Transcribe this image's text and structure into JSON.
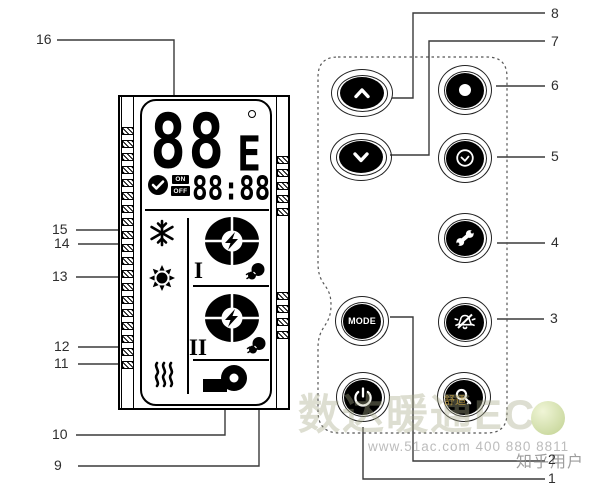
{
  "callouts": {
    "1": "1",
    "2": "2",
    "3": "3",
    "4": "4",
    "5": "5",
    "6": "6",
    "7": "7",
    "8": "8",
    "9": "9",
    "10": "10",
    "11": "11",
    "12": "12",
    "13": "13",
    "14": "14",
    "15": "15",
    "16": "16"
  },
  "display": {
    "value": "88",
    "suffix": "E",
    "degree_symbol": "°",
    "timer_on": "ON",
    "timer_off": "OFF",
    "time": "88:88",
    "stage1": "I",
    "stage2": "II"
  },
  "buttons": {
    "mode_label": "MODE"
  },
  "icons": {
    "display": [
      "degree-icon",
      "check-circle-icon",
      "snowflake-icon",
      "sun-icon",
      "compressor-icon",
      "fan-icon",
      "heater-waves-icon",
      "pump-icon"
    ],
    "buttons": [
      "chevron-up-icon",
      "chevron-down-icon",
      "record-dot-icon",
      "clock-icon",
      "wrench-icon",
      "mode-button",
      "alarm-off-icon",
      "power-icon",
      "key-icon"
    ]
  },
  "watermark": {
    "brand": "数达暖通EC",
    "contact": "www.51ac.com 400 880 8811",
    "user": "知乎用户",
    "stamp": "舒适"
  },
  "colors": {
    "line_art": "#000000",
    "callout_line": "#3a3a3a",
    "watermark_green": "#b9cc84"
  }
}
